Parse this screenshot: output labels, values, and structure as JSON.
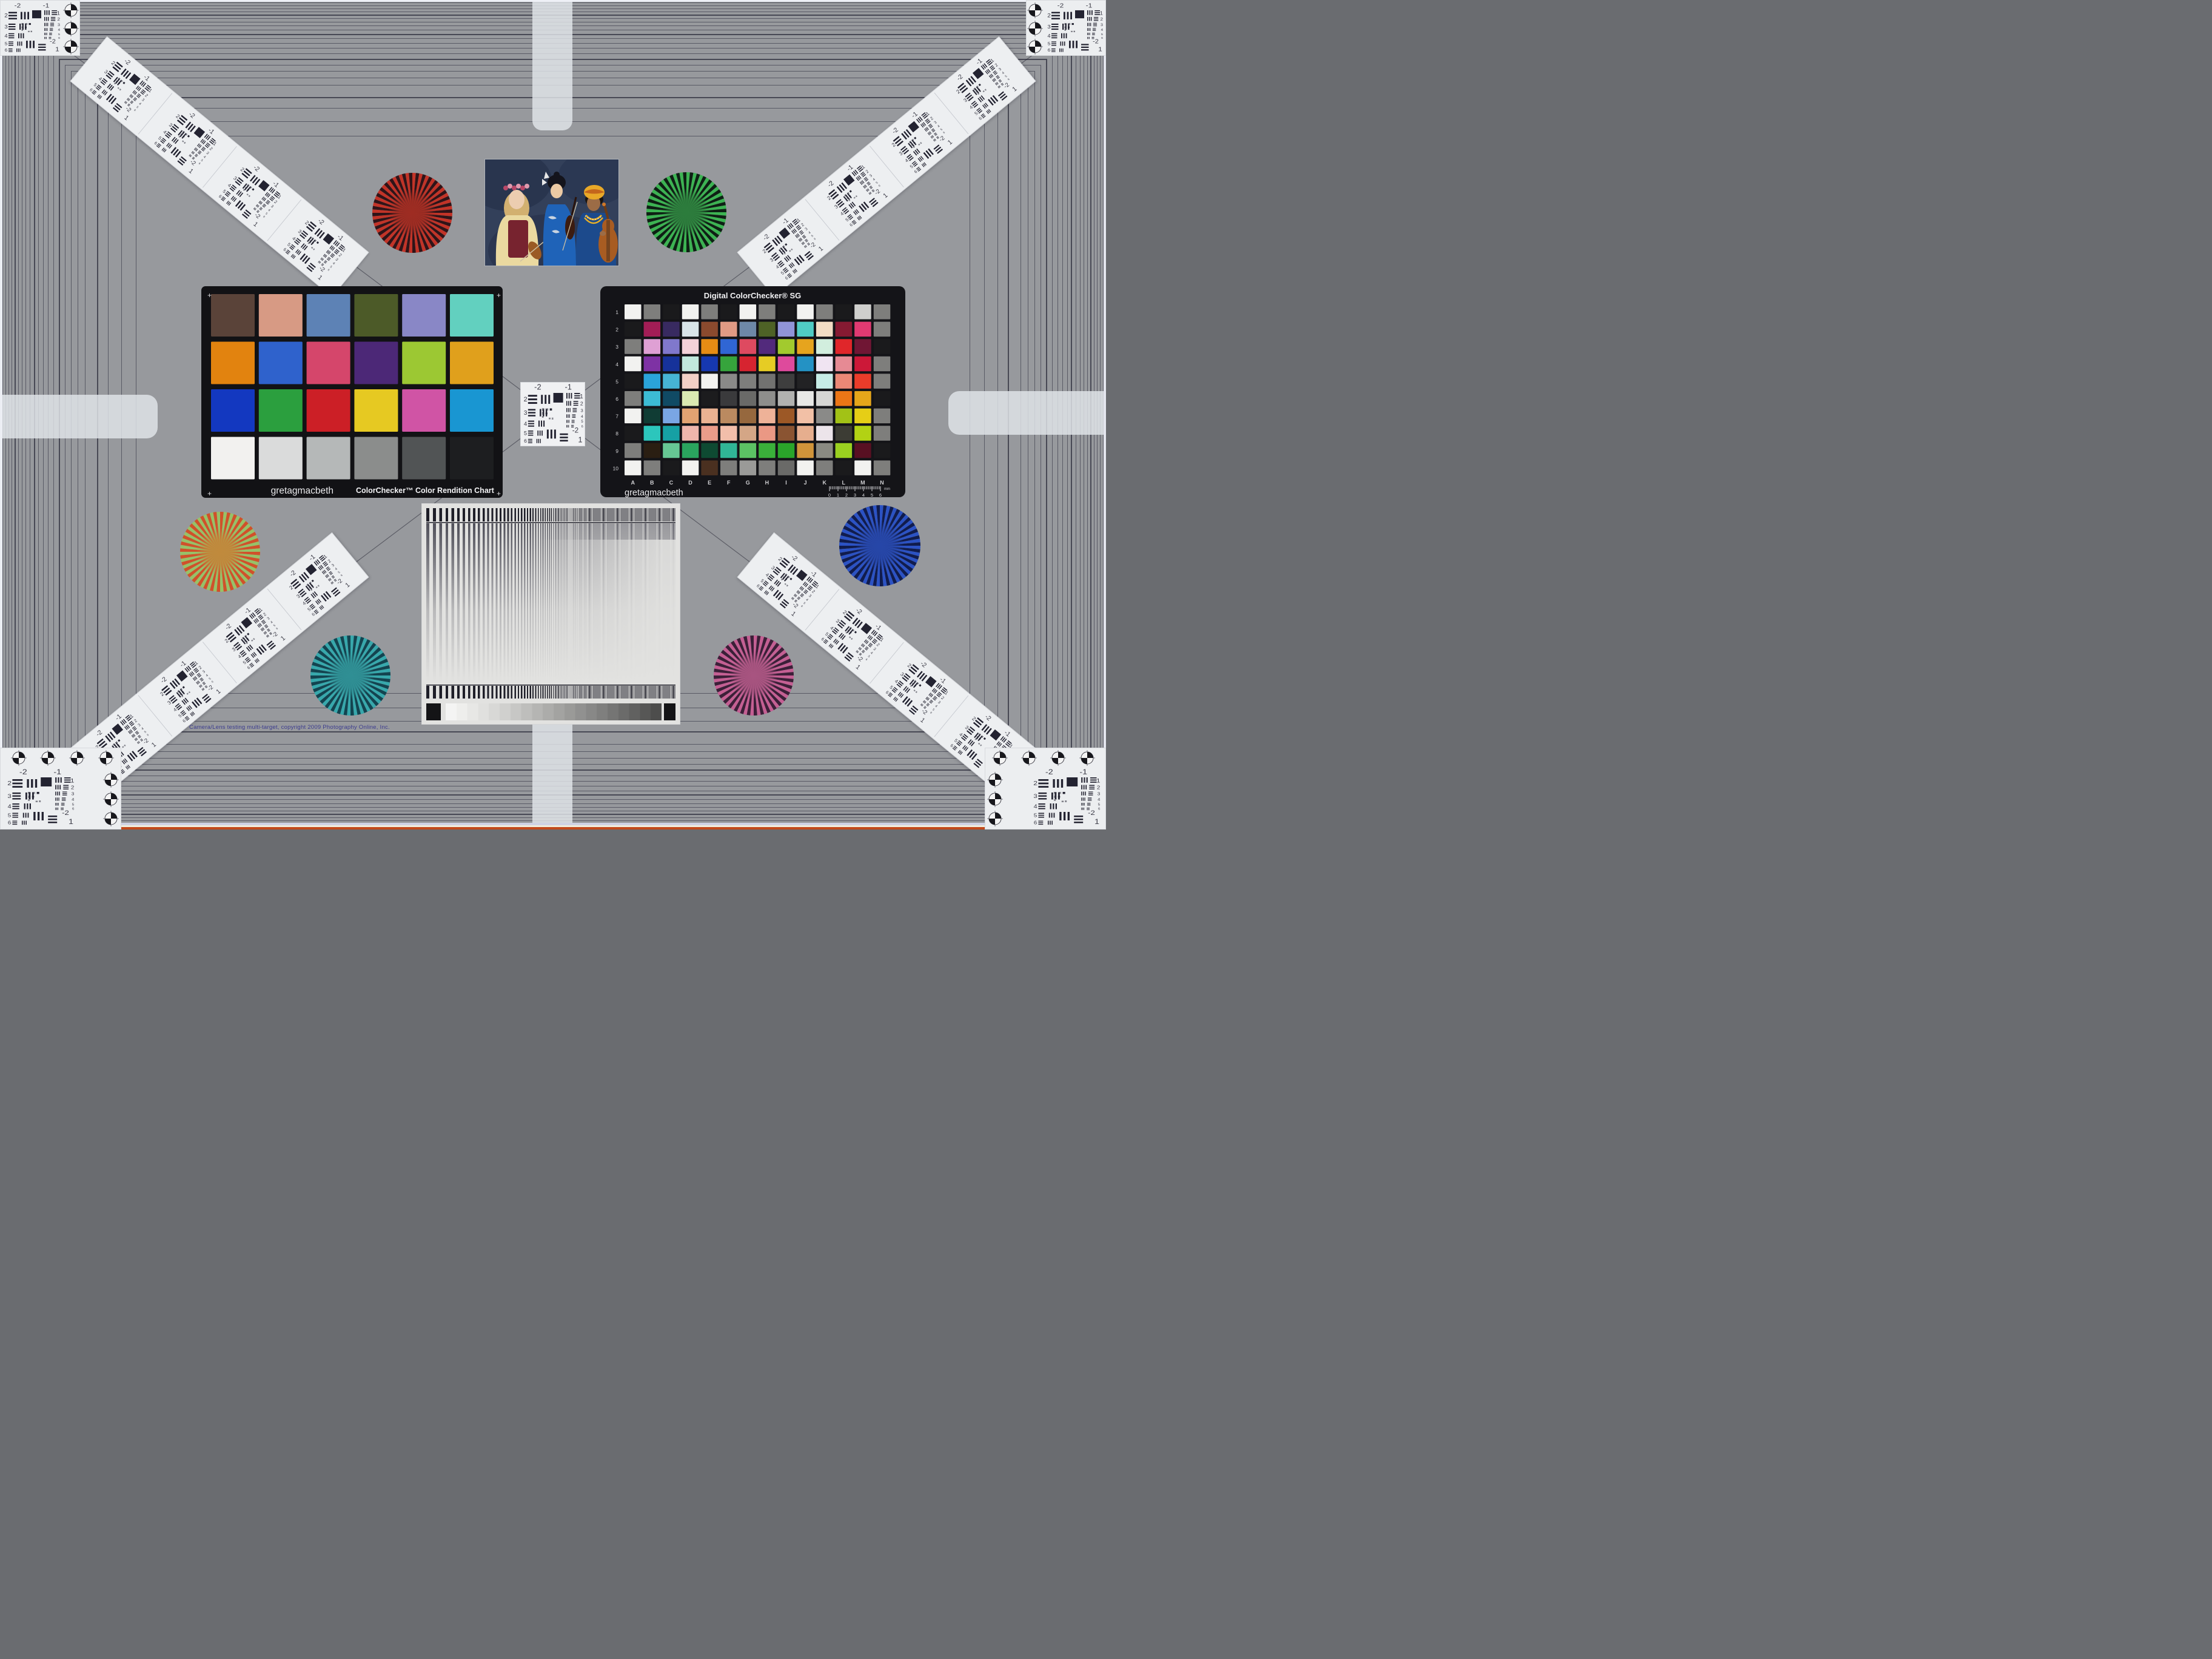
{
  "meta": {
    "description": "Camera/Lens testing multi-target test chart photograph",
    "background": "#97999d",
    "frame_line_color": "#34343f",
    "tab_color": "#e2e5ea"
  },
  "footer": {
    "copyright": "Camera/Lens testing multi-target, copyright 2009 Photography Online, Inc."
  },
  "colorchecker": {
    "brand": "gretagmacbeth",
    "title": "ColorChecker™ Color Rendition Chart",
    "panel_color": "#121215",
    "corner_mark": "+",
    "rows": 4,
    "cols": 6,
    "colors": [
      "#5a4339",
      "#d79a84",
      "#5d82b5",
      "#4c5a28",
      "#8987c6",
      "#62d0bf",
      "#e2830f",
      "#2f62cc",
      "#d5466b",
      "#4c2877",
      "#9cc833",
      "#e0a01c",
      "#1338c0",
      "#2b9f3e",
      "#cc1f26",
      "#e6c922",
      "#d054a5",
      "#1996d2",
      "#f2f1ef",
      "#dadbdb",
      "#b5b8b8",
      "#8b8d8c",
      "#515455",
      "#1d1e20"
    ]
  },
  "sg": {
    "title": "Digital ColorChecker® SG",
    "brand": "gretagmacbeth",
    "panel_color": "#141418",
    "row_labels": [
      "1",
      "2",
      "3",
      "4",
      "5",
      "6",
      "7",
      "8",
      "9",
      "10"
    ],
    "col_labels": [
      "A",
      "B",
      "C",
      "D",
      "E",
      "F",
      "G",
      "H",
      "I",
      "J",
      "K",
      "L",
      "M",
      "N"
    ],
    "ruler": {
      "ticks": [
        "0",
        "1",
        "2",
        "3",
        "4",
        "5",
        "6"
      ],
      "unit": "mm"
    },
    "colors": [
      [
        "#f2f2f0",
        "#7e7e7c",
        "#1a1a1c",
        "#f2f2f0",
        "#7e7e7c",
        "#1a1a1c",
        "#f2f2f0",
        "#7e7e7c",
        "#1a1a1c",
        "#f2f2f0",
        "#7e7e7c",
        "#1a1a1c",
        "#cfcfcd",
        "#7e7e7c"
      ],
      [
        "#1a1a1c",
        "#a21d56",
        "#382a60",
        "#d8e4e8",
        "#8a4a2e",
        "#e09a84",
        "#6e88a8",
        "#4e6226",
        "#9094d8",
        "#50ccc4",
        "#f2dcc4",
        "#861a32",
        "#e03a72",
        "#7e7e7c"
      ],
      [
        "#7e7e7c",
        "#dfa0d4",
        "#8078cc",
        "#f4d2d8",
        "#e68c14",
        "#3066d4",
        "#de4a60",
        "#522a7c",
        "#a2ca2e",
        "#e6a41e",
        "#d2eede",
        "#e0262a",
        "#701634",
        "#1a1a1c"
      ],
      [
        "#f2f2f0",
        "#7e32a4",
        "#16329a",
        "#c2e8dc",
        "#1638b0",
        "#36a43c",
        "#d62430",
        "#e6cc24",
        "#de4a9c",
        "#2492c4",
        "#f0e4f2",
        "#e68a94",
        "#cc1838",
        "#7e7e7c"
      ],
      [
        "#1a1a1c",
        "#2aa4da",
        "#46b4d4",
        "#f2d0c6",
        "#f2f2f0",
        "#8a8a88",
        "#7e7e7c",
        "#727270",
        "#3e3e3e",
        "#222224",
        "#c6ece6",
        "#ea8876",
        "#ea3c2a",
        "#7e7e7c"
      ],
      [
        "#7e7e7c",
        "#3cbcd4",
        "#104a64",
        "#daeab2",
        "#1c1c1e",
        "#3a3a3c",
        "#6a6a68",
        "#8e8e8c",
        "#b2b2b0",
        "#e8e8e6",
        "#d6d6d4",
        "#ec7616",
        "#e6a61a",
        "#1a1a1c"
      ],
      [
        "#f2f2f0",
        "#103c34",
        "#7aa6e4",
        "#e2a372",
        "#eab292",
        "#ba8a60",
        "#96683e",
        "#eeb298",
        "#9c5826",
        "#f2c0a6",
        "#8a8a88",
        "#a2c216",
        "#e6ce16",
        "#7e7e7c"
      ],
      [
        "#1a1a1c",
        "#2cc6bc",
        "#16a0a4",
        "#eeb6ac",
        "#ea9c8a",
        "#f2beaa",
        "#d4a686",
        "#ea9884",
        "#8a5432",
        "#e6ae8e",
        "#ece4ea",
        "#3c3c34",
        "#b2d214",
        "#7e7e7c"
      ],
      [
        "#7e7e7c",
        "#2a1e12",
        "#66c694",
        "#2aa45e",
        "#0e4a32",
        "#30b696",
        "#5cc264",
        "#3ab03a",
        "#2aa42a",
        "#d0943a",
        "#8a8a82",
        "#9ad020",
        "#581022",
        "#1a1a1c"
      ],
      [
        "#f2f2f0",
        "#7e7e7c",
        "#1a1a1c",
        "#f2f2f0",
        "#4a3020",
        "#7e7e7c",
        "#9a9a98",
        "#7e7e7c",
        "#6a6a68",
        "#f2f2f0",
        "#7e7e7c",
        "#1a1a1c",
        "#f2f2f0",
        "#7e7e7c"
      ]
    ]
  },
  "usaf": {
    "top_left": "-2",
    "top_right": "-1",
    "left_rows": [
      "2",
      "3",
      "4",
      "5",
      "6"
    ],
    "right_rows": [
      "1",
      "2",
      "3",
      "4",
      "5",
      "6"
    ],
    "bottom_label": "-2",
    "bottom_number": "1"
  },
  "stars": [
    {
      "id": "red",
      "c1": "#c23327",
      "c2": "#301418",
      "mix": "#9e2c22"
    },
    {
      "id": "green",
      "c1": "#3cb352",
      "c2": "#0e2014",
      "mix": "#2c7c3c"
    },
    {
      "id": "orange",
      "c1": "#d0512a",
      "c2": "#97c168",
      "mix": "#c08a3c"
    },
    {
      "id": "blue",
      "c1": "#2b52c4",
      "c2": "#101c4e",
      "mix": "#2646a8"
    },
    {
      "id": "teal",
      "c1": "#37a8ac",
      "c2": "#134450",
      "mix": "#2f8f94"
    },
    {
      "id": "magenta",
      "c1": "#c45f93",
      "c2": "#3c1f38",
      "mix": "#a85480"
    }
  ],
  "sweep": {
    "bg": "#e2e2e0",
    "bar_color": "#1e1e28",
    "stripe_color": "#50505a",
    "divider_color": "#20202a",
    "wedge_end_color": "#141416",
    "gray_steps": [
      "#f4f4f3",
      "#eeeeec",
      "#e7e7e5",
      "#e0e0de",
      "#d8d8d6",
      "#d0d0ce",
      "#c7c7c5",
      "#bebebc",
      "#b5b5b3",
      "#acacaa",
      "#a3a3a1",
      "#9a9a98",
      "#919190",
      "#888887",
      "#7f7f7e",
      "#757574",
      "#6b6b6a",
      "#616160",
      "#575756",
      "#4d4d4c"
    ]
  },
  "photo": {
    "backdrop": "#33405a",
    "skin_left": "#eccdb0",
    "hair_left": "#d2b070",
    "crown_a": "#b84868",
    "crown_b": "#e09aae",
    "blouse": "#ead9a0",
    "bodice": "#77232f",
    "skin_center": "#eccaa4",
    "hair_center": "#14141c",
    "kimono": "#1f63b8",
    "accent_white": "#e8e8e8",
    "skin_right": "#9c6c46",
    "headwrap": "#e8a828",
    "wrap_stripe": "#c4661c",
    "garment": "#1c4a8c",
    "gold": "#e8b028",
    "cello": "#a85c22",
    "violin": "#9a5a24",
    "bow": "#cfc2a4"
  }
}
